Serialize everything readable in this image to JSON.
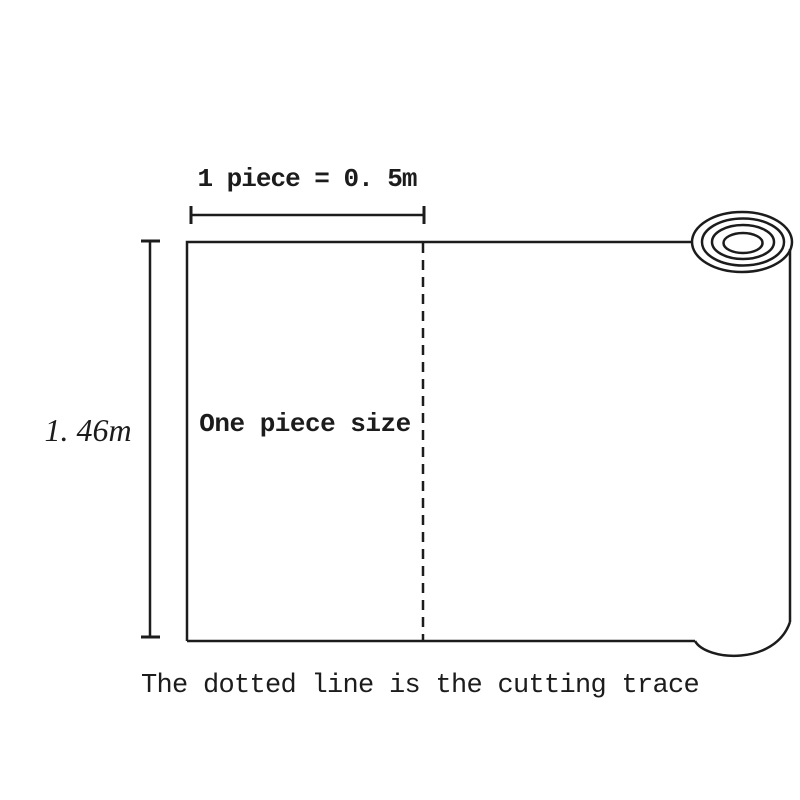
{
  "colors": {
    "line": "#1c1c1c",
    "background": "#ffffff"
  },
  "diagram": {
    "top_dimension": {
      "label": "1 piece = 0. 5m"
    },
    "left_dimension": {
      "label": "1. 46m"
    },
    "sheet": {
      "piece_label": "One piece size"
    },
    "caption": "The dotted line is the cutting trace"
  }
}
